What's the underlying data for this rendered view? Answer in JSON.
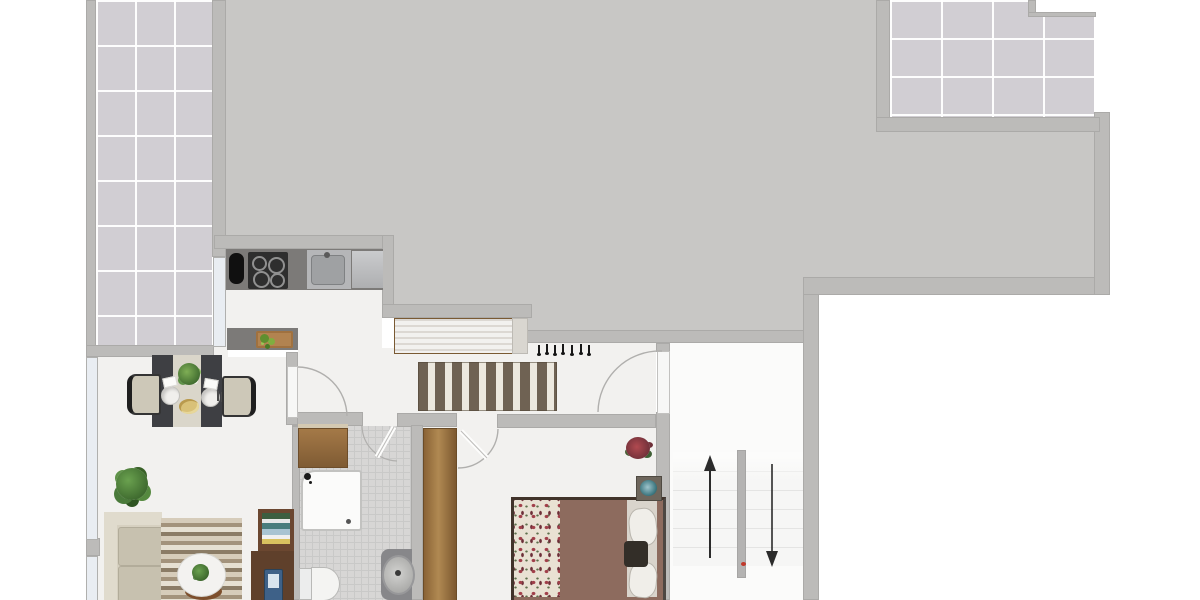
{
  "palette": {
    "wall": "#bcbbb9",
    "roof": "#c8c7c5",
    "tile": "#d1ced3",
    "floor": "#f2f1ef",
    "bath_tile": "#d7d6d5",
    "counter": "#7c7a78",
    "window": "#e9edf2",
    "rug_dark": "#6f6253",
    "rug_light": "#ece8de",
    "wood_dark": "#5f402b",
    "duvet": "#8d6b5e",
    "floral_bg": "#e9e1d3",
    "floral_dot": "#a13f4a",
    "teal": "#2e6b74",
    "plant_green": "#4a7a3a",
    "sofa_beige": "#d6d0c0",
    "stove_black": "#2e2e2e",
    "sink_steel": "#b5b6b8",
    "arrow_black": "#2b2b2b",
    "accent_red": "#c0392b"
  },
  "floorplan": {
    "rooms": {
      "balcony": {
        "name": "side balcony",
        "floor": "large gray tiles"
      },
      "roof_terrace": {
        "name": "roof terrace",
        "floor": "plain gray"
      },
      "upper_terrace": {
        "name": "upper tiled terrace",
        "floor": "large gray tiles"
      },
      "kitchen": {
        "name": "kitchen",
        "items": [
          "refrigerator",
          "stove-4-burners",
          "sink-unit",
          "steel-counter",
          "island-counter",
          "cutting-board-with-vegetables",
          "window"
        ]
      },
      "hallway": {
        "name": "hallway",
        "items": [
          "wood-sideboard",
          "striped-runner-rug",
          "coat-hook-rail",
          "front-door"
        ]
      },
      "dining_room": {
        "name": "dining room",
        "items": [
          "dining-table-dark-runners",
          "chair-left",
          "chair-right",
          "plate-left",
          "plate-right",
          "centerpiece-plant",
          "fruit-bowl",
          "potted-plant",
          "window-upper",
          "window-lower"
        ]
      },
      "living_room": {
        "name": "living room",
        "items": [
          "sofa",
          "striped-area-rug",
          "round-coffee-table",
          "table-plant",
          "wood-stool",
          "bookshelf-with-books",
          "desk",
          "laptop"
        ]
      },
      "bathroom": {
        "name": "bathroom",
        "items": [
          "wood-cabinet",
          "shower",
          "toilet",
          "washbasin"
        ]
      },
      "bedroom": {
        "name": "bedroom",
        "items": [
          "wardrobe",
          "double-bed",
          "floral-bed-runner",
          "brown-duvet",
          "pillows",
          "bedside-teal-bowl",
          "flower-plant",
          "door"
        ]
      },
      "staircase": {
        "name": "staircase",
        "items": [
          "up-flight",
          "down-flight",
          "divider-wall",
          "up-arrow",
          "down-arrow"
        ]
      }
    },
    "stairs": {
      "up_arrow_glyph": "↑",
      "down_arrow_glyph": "↓",
      "flights": 2
    },
    "counts": {
      "coat_hooks": 7,
      "stove_burners": 4,
      "dining_chairs": 2,
      "plates": 2,
      "windows": 3,
      "door_swings": 4
    }
  }
}
